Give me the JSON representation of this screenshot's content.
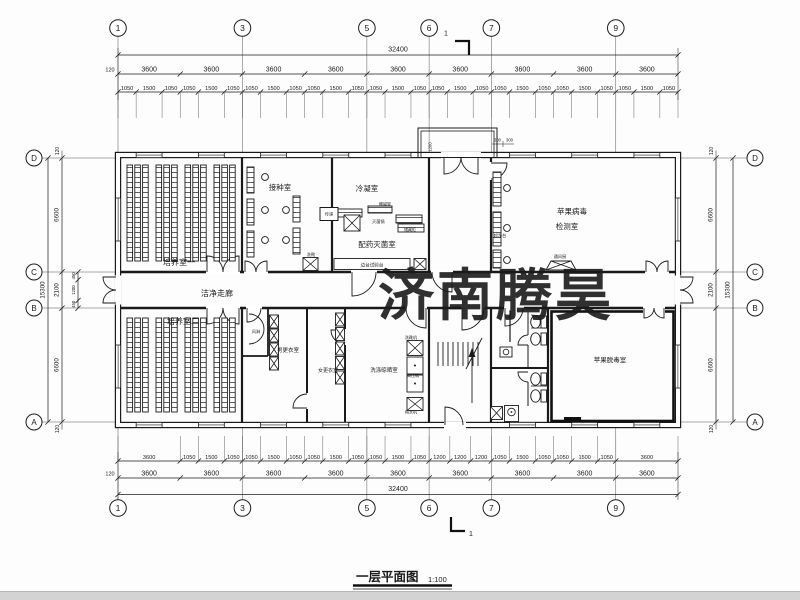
{
  "watermark": {
    "text": "济南腾昊",
    "color": "#e5262e"
  },
  "title": {
    "text": "一层平面图",
    "scale": "1:100"
  },
  "grid": {
    "cols": [
      "1",
      "3",
      "5",
      "6",
      "7",
      "9"
    ],
    "rows": [
      "D",
      "C",
      "B",
      "A"
    ]
  },
  "section_mark": {
    "label": "1"
  },
  "dims": {
    "overall_width": "32400",
    "overall_height": "15300",
    "edge": "120",
    "bay_dims": [
      "3600",
      "3600",
      "3600",
      "3600",
      "3600",
      "3600",
      "3600",
      "3600",
      "3600"
    ],
    "top_fine": [
      "1050",
      "1500",
      "1050",
      "1050",
      "1500",
      "1050",
      "1050",
      "1500",
      "1050",
      "1050",
      "1500",
      "1050",
      "1050",
      "1500",
      "1050",
      "1050",
      "1500",
      "1050",
      "1050",
      "1500",
      "1050",
      "1050",
      "1500",
      "1050",
      "1050",
      "1500",
      "1050"
    ],
    "bottom_fine": [
      "3600",
      "1050",
      "1500",
      "1050",
      "1050",
      "1500",
      "1050",
      "1050",
      "1500",
      "1050",
      "1050",
      "1500",
      "1050",
      "1200",
      "1200",
      "1200",
      "1050",
      "1500",
      "1050",
      "1050",
      "1500",
      "1050",
      "3600"
    ],
    "left_segments": [
      "6600",
      "2100",
      "6600"
    ],
    "left_sub": [
      "450",
      "1200",
      "450"
    ],
    "right_segments": [
      "6600",
      "2100",
      "6600"
    ],
    "canopy": {
      "depth": "1200",
      "left": "300",
      "right": "300"
    }
  },
  "rooms": {
    "cultivation1": "培养室一",
    "inoculation": "接种室",
    "condensation": "冷凝室",
    "preparation": "配药灭菌室",
    "virus_test_line1": "苹果病毒",
    "virus_test_line2": "检测室",
    "corridor": "洁净走廊",
    "cultivation2": "培养室二",
    "men_change": "男更衣室",
    "women_change": "女更衣室",
    "washing": "洗涤晾晒室",
    "detox": "苹果脱毒室"
  },
  "equipment": {
    "transfer": "传递",
    "boot_wash": "洗靴",
    "sterilizer": "灭菌锅",
    "acid_rack": "酸碱架",
    "cabinet": "储藏柜",
    "side_bench": "边台试验台",
    "clean_bench": "超净台",
    "fume_hood": "通风厨",
    "air_shower": "风淋",
    "boot_washer": "洗靴机",
    "autoclave": "高压锅",
    "water_purifier": "纯水机"
  }
}
